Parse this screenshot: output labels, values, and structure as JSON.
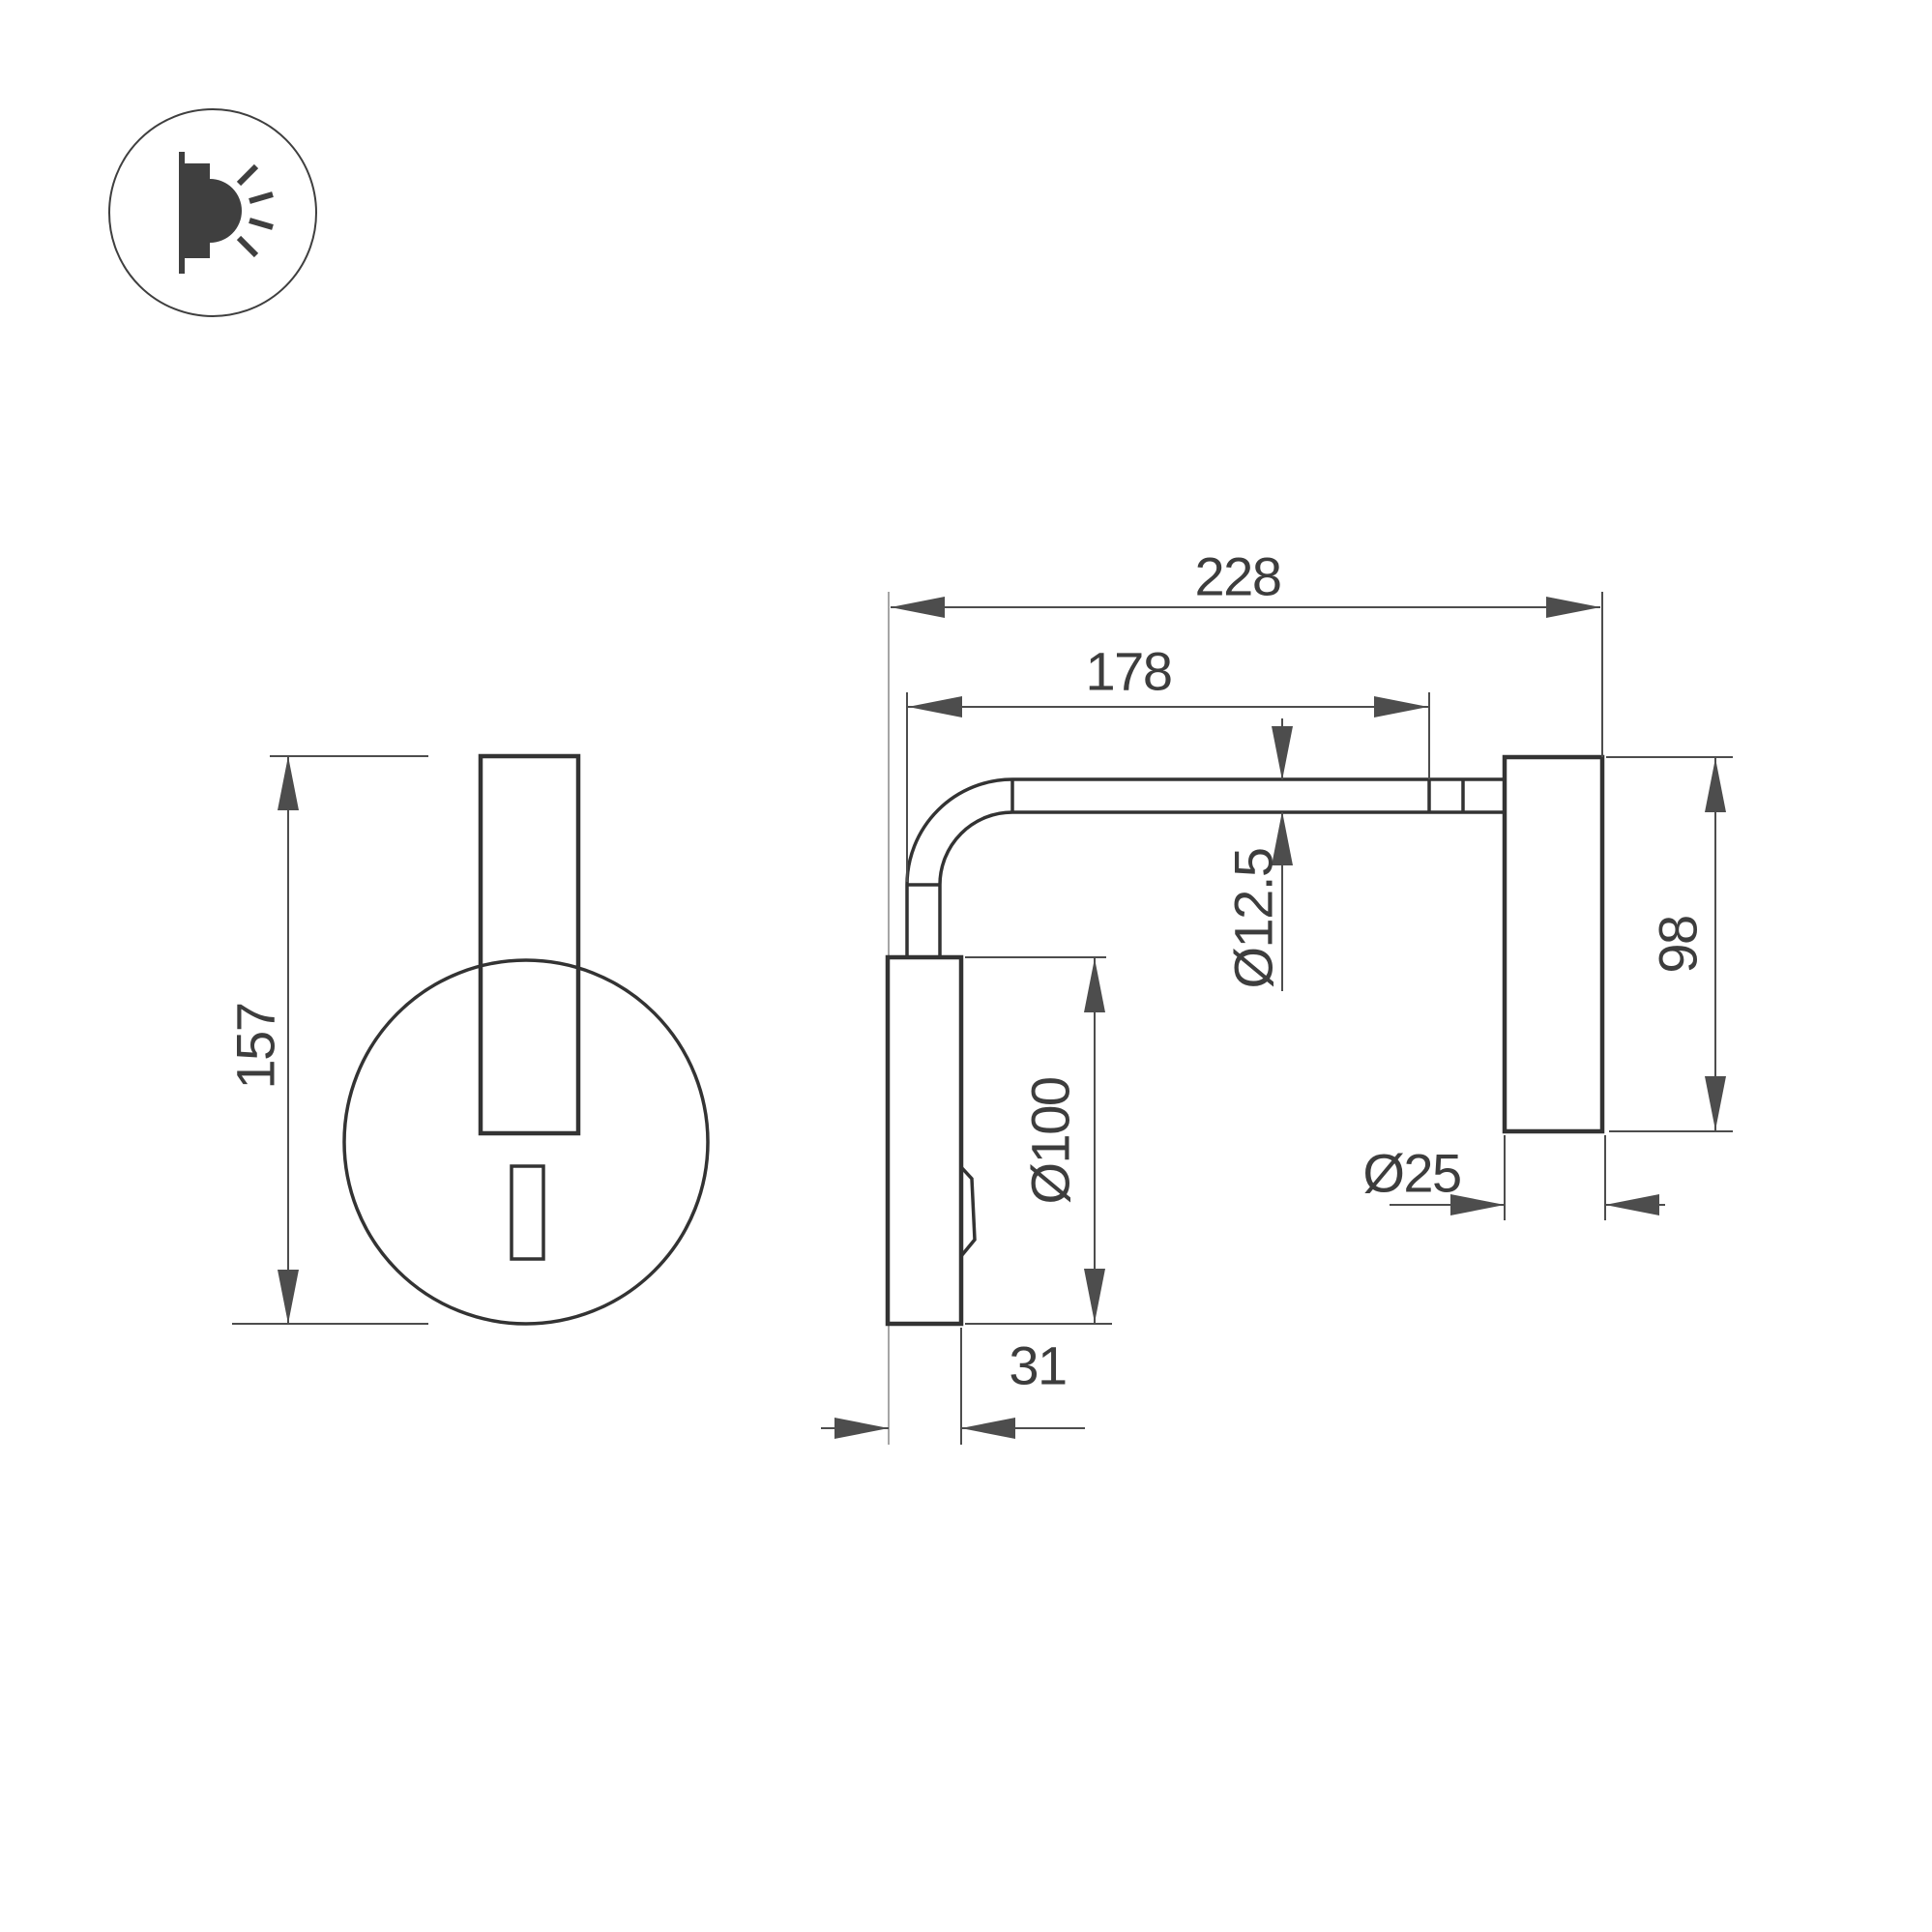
{
  "colors": {
    "background": "#ffffff",
    "outline": "#333333",
    "dimension": "#4d4d4d",
    "text": "#3d3d3d",
    "wall_reference": "#a6a6a6",
    "icon": "#3f3f3f"
  },
  "icon": {
    "name": "wall-lamp-side-light-emission"
  },
  "front_view": {
    "dimensions": {
      "height": "157"
    }
  },
  "side_view": {
    "dimensions": {
      "total_depth": "228",
      "arm_length": "178",
      "arm_diameter": "Ø12.5",
      "head_length": "98",
      "base_diameter": "Ø100",
      "head_diameter": "Ø25",
      "base_depth": "31"
    }
  }
}
